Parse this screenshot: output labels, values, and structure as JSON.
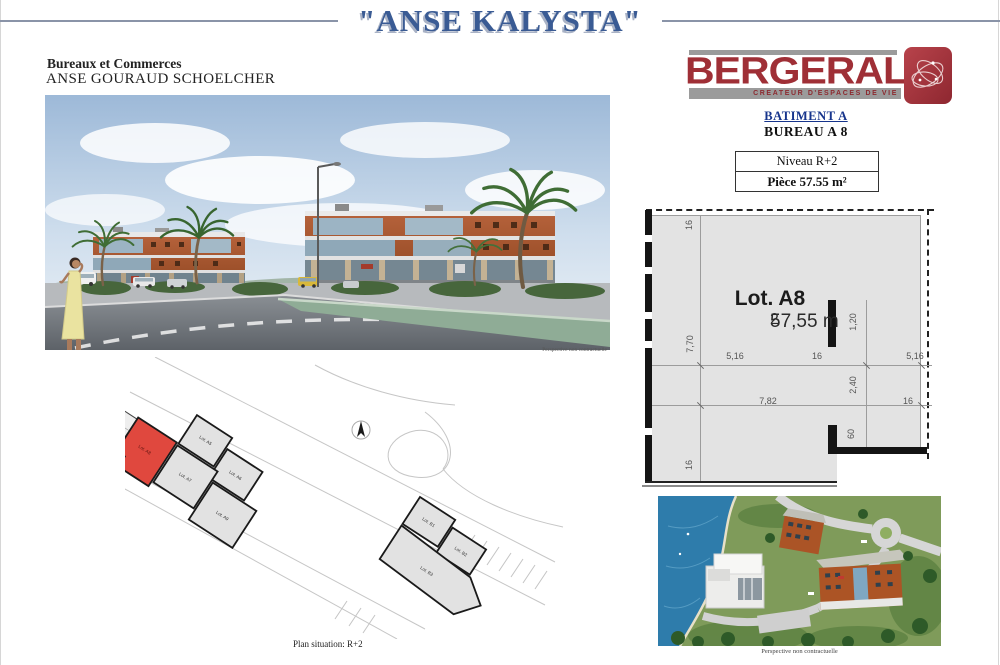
{
  "page": {
    "title": "\"ANSE KALYSTA\"",
    "subtitle1": "Bureaux et Commerces",
    "subtitle2": "ANSE GOURAUD SCHOELCHER"
  },
  "brand": {
    "name": "BERGERAL",
    "tagline": "CREATEUR D'ESPACES DE VIE"
  },
  "unit": {
    "batiment": "BATIMENT A",
    "bureau": "BUREAU A 8",
    "niveau": "Niveau R+2",
    "piece": "Pièce 57.55 m²"
  },
  "floorplan": {
    "lot": "Lot. A8",
    "area": "57,55 m",
    "area_sup": "2",
    "dims": {
      "top16": "16",
      "h770": "7,70",
      "w516l": "5,16",
      "w16m": "16",
      "w516r": "5,16",
      "v120": "1,20",
      "v240": "2,40",
      "w782": "7,82",
      "w16r": "16",
      "v60": "60",
      "bottom16": "16"
    }
  },
  "captions": {
    "perspective": "Perspective non contractuelle",
    "aerial": "Perspective non contractuelle",
    "siteplan": "Plan situation: R+2"
  },
  "siteplan": {
    "a_lots": [
      "Lot. A5",
      "Lot. A6",
      "Lot. A7",
      "Lot. A8",
      "Lot. A9"
    ],
    "b_lots": [
      "Lot. B1",
      "Lot. B2",
      "Lot. B3"
    ]
  },
  "colors": {
    "title_blue": "#3a5b94",
    "brand_red": "#9f2f36",
    "batiment_blue": "#16348c",
    "lot_red": "#e0483e",
    "plan_gray": "#e3e3e3"
  }
}
